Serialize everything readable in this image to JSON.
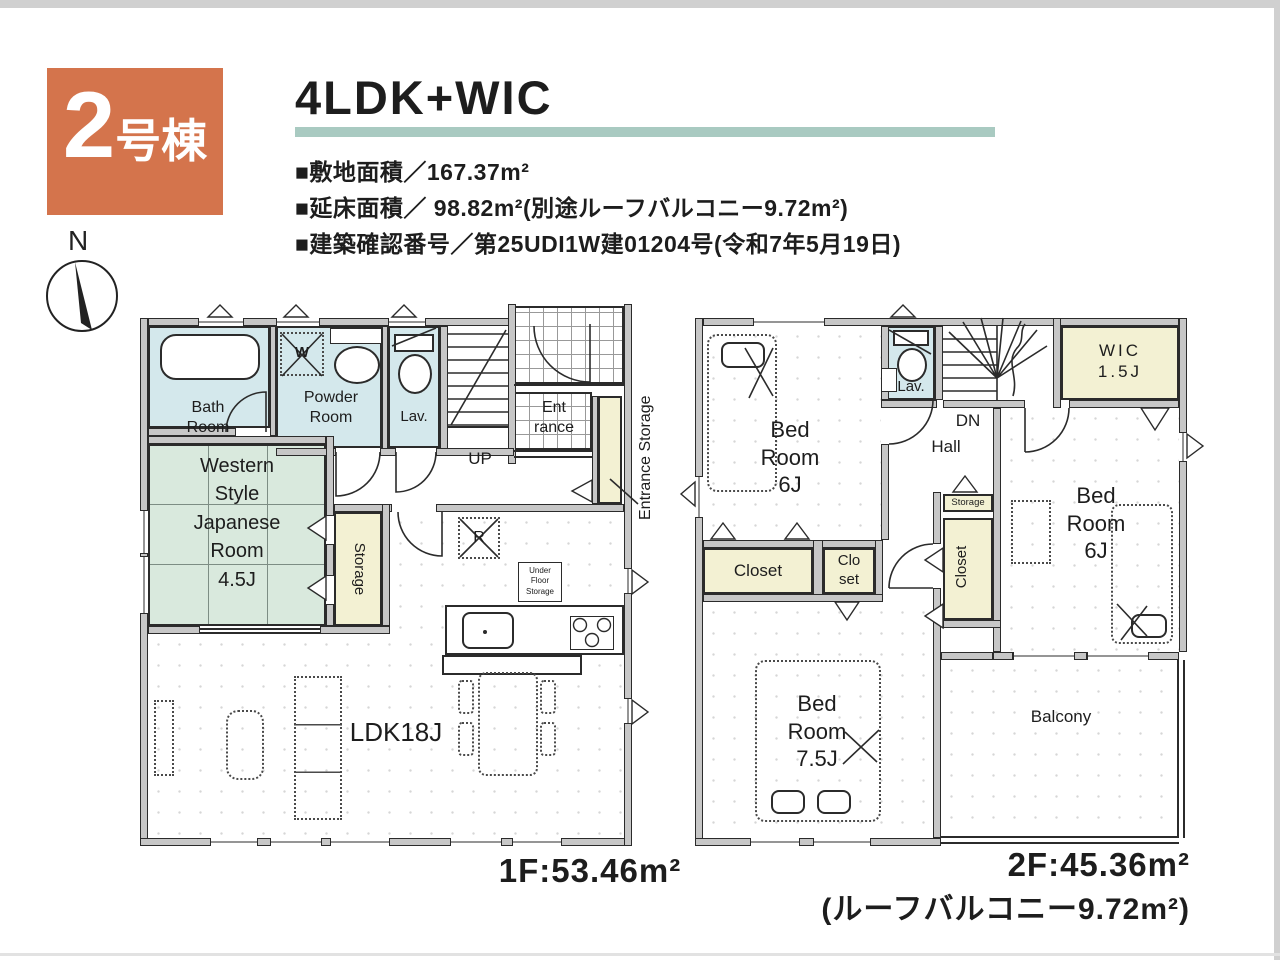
{
  "colors": {
    "accent_orange": "#d4744c",
    "title_underline": "#a9cac1",
    "wet_room_blue": "#d4e8ec",
    "tatami_green": "#d9e9dd",
    "storage_yellow": "#f3f1d3",
    "wall_gray": "#c7c7c7"
  },
  "header": {
    "unit_number": "2",
    "unit_suffix": "号棟",
    "plan_type": "4LDK+WIC",
    "specs": [
      "■敷地面積／167.37m²",
      "■延床面積／ 98.82m²(別途ルーフバルコニー9.72m²)",
      "■建築確認番号／第25UDI1W建01204号(令和7年5月19日)"
    ]
  },
  "compass": {
    "north": "N"
  },
  "floor1": {
    "area": "1F:53.46m²",
    "bath": "Bath\nRoom",
    "powder": "Powder\nRoom",
    "lav": "Lav.",
    "washer": "W",
    "up": "UP",
    "entrance": "Ent\nrance",
    "entrance_storage": "Entrance Storage",
    "japanese": "Western\nStyle\nJapanese\nRoom\n4.5J",
    "storage": "Storage",
    "fridge": "R",
    "under_floor": "Under\nFloor\nStorage",
    "ldk": "LDK18J"
  },
  "floor2": {
    "area": "2F:45.36m²",
    "area_note": "(ルーフバルコニー9.72m²)",
    "bedroom_a": "Bed\nRoom\n6J",
    "lav": "Lav.",
    "dn": "DN",
    "hall": "Hall",
    "wic": "WIC\n1.5J",
    "bedroom_b": "Bed\nRoom\n6J",
    "storage": "Storage",
    "closet_a": "Closet",
    "closet_b": "Clo\nset",
    "closet_c": "Closet",
    "bedroom_c": "Bed\nRoom\n7.5J",
    "balcony": "Balcony"
  }
}
